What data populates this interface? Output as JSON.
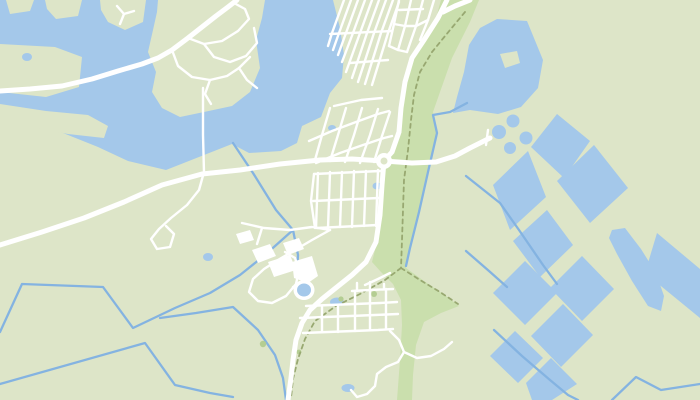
{
  "map": {
    "viewport": {
      "width": 700,
      "height": 400
    },
    "colors": {
      "land": "#dde5c8",
      "park": "#cadfad",
      "water": "#a4c8ea",
      "canal": "#84b3e1",
      "road": "#ffffff",
      "path_dash": "#98a871",
      "tree": "#b4cd92"
    },
    "park_polygons": [
      "441,0 479,0 470,22 452,58 440,92 433,112 437,133 428,172 419,212 410,248 406,268 424,281 446,296 459,306 441,313 424,322 416,345 413,375 412,400 397,400 400,360 402,325 401,300 393,284 381,272 372,262 377,242 380,215 382,185 384,161 392,152 399,132 401,108 405,82 412,58 424,40 436,18"
    ],
    "water_polygons": [
      "0,0 333,0 340,28 344,55 342,78 330,93 321,117 302,126 297,143 281,151 249,153 232,144 199,157 166,170 128,161 98,147 63,133 27,123 0,117",
      "497,19 527,21 543,60 538,88 521,107 498,114 470,110 453,113 457,97 464,72 469,45 480,28"
    ],
    "land_patches": [
      "6,0 34,0 30,11 10,14",
      "45,0 82,0 78,16 56,19 47,9",
      "100,0 146,0 143,22 125,30 108,22 101,10",
      "158,0 265,0 262,18 256,40 260,68 250,92 232,106 204,112 180,117 162,108 152,92 156,72 148,52 153,30 157,12",
      "0,44 55,47 82,57 79,87 46,97 0,92",
      "0,104 46,111 88,115 108,126 104,138 68,134 30,127 0,123",
      "500,54 517,51 520,63 505,68"
    ],
    "basins": [
      "493,185 528,151 546,197 510,230",
      "531,147 557,114 590,141 564,178",
      "557,181 594,145 628,188 590,223",
      "513,241 547,210 573,245 540,277",
      "493,293 525,261 557,293 525,325",
      "550,288 582,256 614,289 582,321",
      "531,336 563,304 593,335 561,367",
      "490,356 515,331 543,358 518,383",
      "526,383 551,358 577,384 552,400 532,400",
      "657,233 700,269 700,318 645,273",
      "612,230 625,228 641,249 656,273 664,296 661,311 648,306 632,281 617,254 609,238"
    ],
    "canals": [
      "233,143 253,173 276,210 293,230 298,255 297,272",
      "293,230 265,255 240,275 210,293 175,308 133,328 103,287 22,284 0,332",
      "0,384 145,343 175,385 210,393 233,397",
      "160,318 196,313 233,307 258,330 275,355 283,378 286,400",
      "467,103 450,112 433,115 437,133 428,172 419,212 410,248 406,266",
      "466,176 500,203 519,230 543,265 557,284",
      "466,251 489,271 507,287",
      "494,330 522,356 550,380 568,395 578,400",
      "612,400 636,377 661,390 700,384"
    ],
    "paths_dashed": [
      "465,12 450,30 432,52 420,72 414,95 411,120 408,150 404,180 403,210 402,240 401,268",
      "401,268 385,280 360,294 336,306 315,321 305,339 298,359 293,379 291,398",
      "401,268 420,280 440,292 458,304"
    ],
    "roads_major": [
      "447,0 438,18 424,40 412,58 405,82 401,108 399,132 392,152 384,161 382,185 380,215 376,242 366,262 352,275 337,287 322,299 310,310 302,323 296,340 293,360 291,378 288,400",
      "0,245 42,232 84,218 124,202 162,185 202,174 240,170 280,164 320,160 352,159 384,161 412,163 436,162 455,156 470,148 484,141 490,138",
      "0,91 30,89 62,86 92,79 118,71 142,64 158,58 172,50 188,38 202,27 216,16 228,7 237,0",
      "443,12 455,6 470,0"
    ],
    "roads_minor": [
      "188,38 204,44 222,41 238,31 249,19 245,9 234,3",
      "204,44 214,57 230,62 246,56 257,43 254,28",
      "172,50 178,66 192,77 210,80 227,76 239,68 250,57",
      "210,80 205,94 211,104",
      "239,68 247,80 257,88",
      "203,88 203,135 204,172",
      "117,6 124,14 134,11",
      "124,14 120,24",
      "204,172 199,190 187,205 171,218 159,229 151,239 157,249 170,247 174,234 166,226",
      "344,0 332,33 328,46",
      "351,0 339,33 333,50",
      "358,0 346,33 338,55",
      "365,0 353,33 342,62",
      "372,0 360,33 346,72",
      "379,0 367,33 352,78",
      "386,0 374,33 358,82",
      "393,0 381,33 365,84",
      "399,2 388,33 372,85",
      "330,34 392,31",
      "350,63 388,60",
      "399,0 394,24 389,46",
      "411,0 405,26 398,50",
      "423,0 416,26 407,52",
      "434,0 428,20 420,40",
      "389,46 398,50 407,52",
      "394,24 405,26 416,26 428,20",
      "399,10 423,9",
      "330,108 322,135 315,160",
      "346,108 338,135 330,161",
      "362,108 354,135 345,162",
      "378,109 370,135 360,163",
      "390,112 382,136 374,162",
      "309,141 332,131 356,122 378,114 389,111",
      "316,163 340,153 363,145 384,138 392,136",
      "334,106 361,100 382,98",
      "318,173 316,228",
      "330,172 328,228",
      "342,172 340,227",
      "354,171 352,227",
      "366,171 364,226",
      "378,170 376,226",
      "314,174 380,171",
      "313,201 379,198",
      "317,228 378,225",
      "314,174 311,201 315,228",
      "352,291 370,290 393,289",
      "306,306 330,305 355,304 380,303 397,302",
      "300,318 325,317 350,316 375,315 398,314",
      "303,333 328,332 353,331 378,330 393,329",
      "357,283 357,291",
      "370,282 370,290",
      "384,284 384,289",
      "322,306 322,332",
      "338,305 338,332",
      "355,291 355,331",
      "370,290 370,330",
      "386,289 386,329",
      "365,285 378,279 390,273",
      "390,331 399,340 404,352 398,362 386,367 377,374 375,386 367,394 357,397 351,390",
      "404,352 417,358 431,356 444,349 452,342",
      "330,230 312,240 295,250 278,260 264,269 253,279 249,292 258,301 272,303 286,296 296,284 299,270 295,258 285,252",
      "242,223 264,228 290,230 312,227 330,230",
      "293,287 302,291",
      "262,228 257,244",
      "486,145 488,130"
    ],
    "buildings": [
      "252,250 270,244 276,256 258,263",
      "268,262 290,255 296,270 274,277",
      "283,243 299,238 304,249 288,255",
      "236,234 250,230 254,240 240,244",
      "292,262 312,256 318,276 308,283 294,278"
    ],
    "ponds": [
      {
        "cx": 499,
        "cy": 132,
        "rx": 7,
        "ry": 7
      },
      {
        "cx": 513,
        "cy": 121,
        "rx": 6.5,
        "ry": 6.5
      },
      {
        "cx": 526,
        "cy": 138,
        "rx": 6.5,
        "ry": 6.5
      },
      {
        "cx": 510,
        "cy": 148,
        "rx": 6,
        "ry": 6
      },
      {
        "cx": 27,
        "cy": 57,
        "rx": 5,
        "ry": 4
      },
      {
        "cx": 377,
        "cy": 186,
        "rx": 4.5,
        "ry": 3.5
      },
      {
        "cx": 208,
        "cy": 257,
        "rx": 5,
        "ry": 4
      },
      {
        "cx": 337,
        "cy": 302,
        "rx": 7,
        "ry": 4.5
      },
      {
        "cx": 348,
        "cy": 388,
        "rx": 6.5,
        "ry": 4
      },
      {
        "cx": 332,
        "cy": 128,
        "rx": 4,
        "ry": 3
      }
    ],
    "pond_rings": [
      {
        "cx": 304,
        "cy": 290,
        "rx": 7,
        "ry": 6.5,
        "ring": 3.5
      }
    ],
    "trees": [
      {
        "cx": 374,
        "cy": 294,
        "r": 3
      },
      {
        "cx": 341,
        "cy": 299,
        "r": 2.6
      },
      {
        "cx": 263,
        "cy": 344,
        "r": 3.2
      },
      {
        "cx": 299,
        "cy": 352,
        "r": 2.4
      }
    ],
    "roundabout": {
      "cx": 384,
      "cy": 161,
      "r": 8,
      "hole": 3.5
    }
  }
}
